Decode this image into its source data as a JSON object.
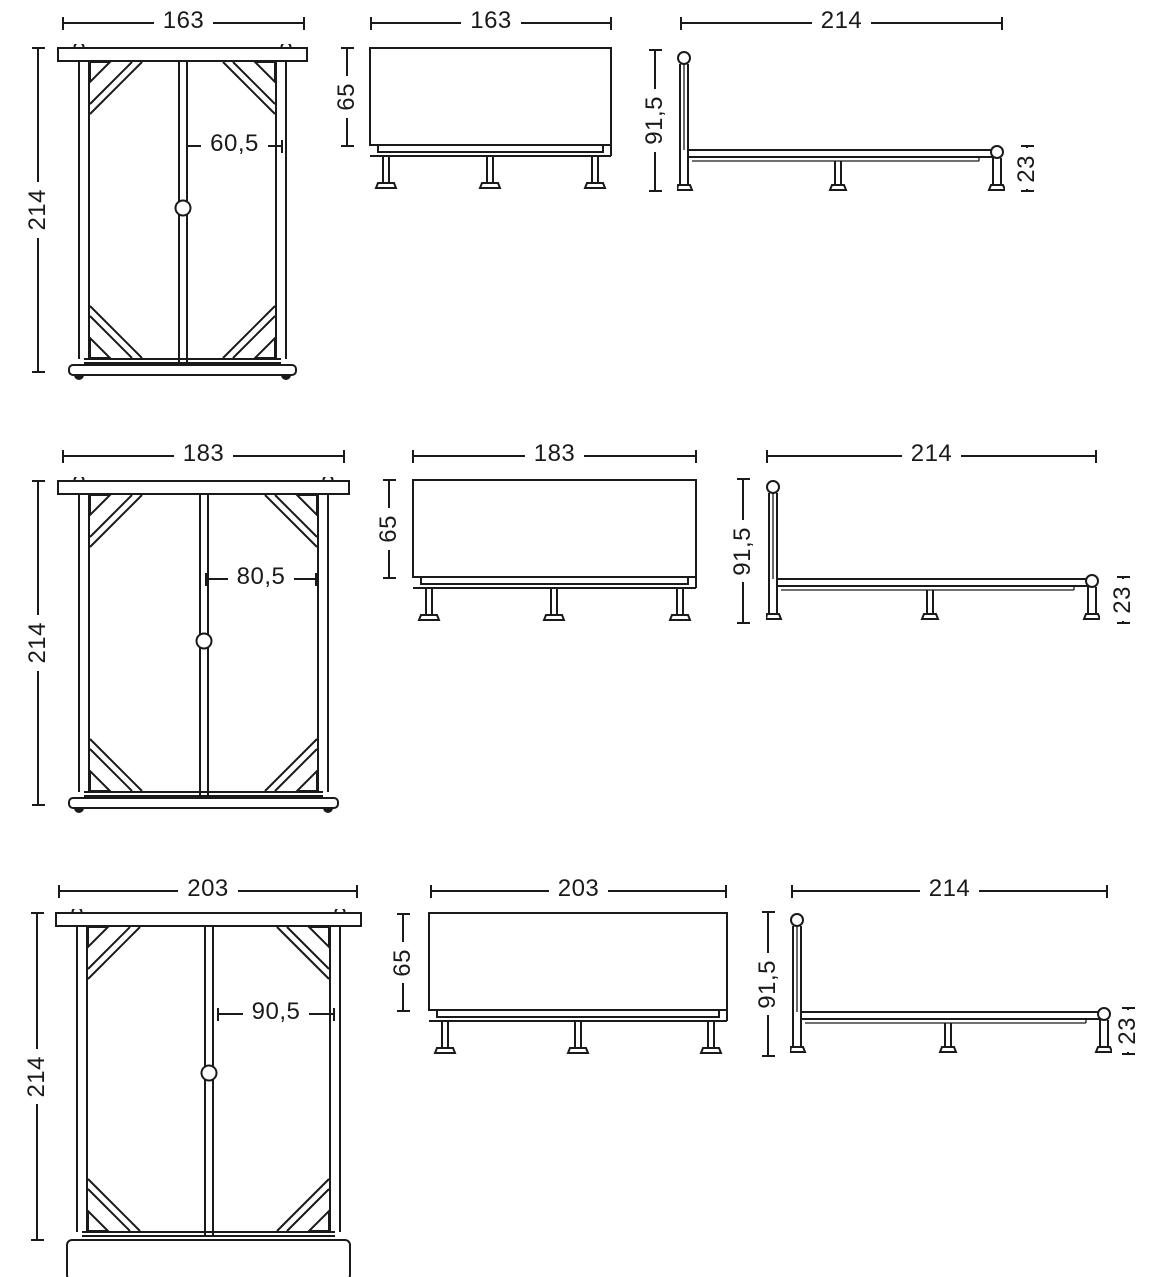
{
  "document": {
    "type": "bed-frame-technical-drawing",
    "views": [
      "top view",
      "front view",
      "side view"
    ]
  },
  "colors": {
    "line": "#1a1a1a",
    "background": "#ffffff"
  },
  "rows": [
    {
      "plan": {
        "width": "163",
        "height": "214",
        "half_width": "60,5"
      },
      "front": {
        "width": "163",
        "height": "65"
      },
      "side": {
        "length": "214",
        "headboard_height": "91,5",
        "frame_height": "23"
      }
    },
    {
      "plan": {
        "width": "183",
        "height": "214",
        "half_width": "80,5"
      },
      "front": {
        "width": "183",
        "height": "65"
      },
      "side": {
        "length": "214",
        "headboard_height": "91,5",
        "frame_height": "23"
      }
    },
    {
      "plan": {
        "width": "203",
        "height": "214",
        "half_width": "90,5"
      },
      "front": {
        "width": "203",
        "height": "65"
      },
      "side": {
        "length": "214",
        "headboard_height": "91,5",
        "frame_height": "23"
      }
    }
  ]
}
